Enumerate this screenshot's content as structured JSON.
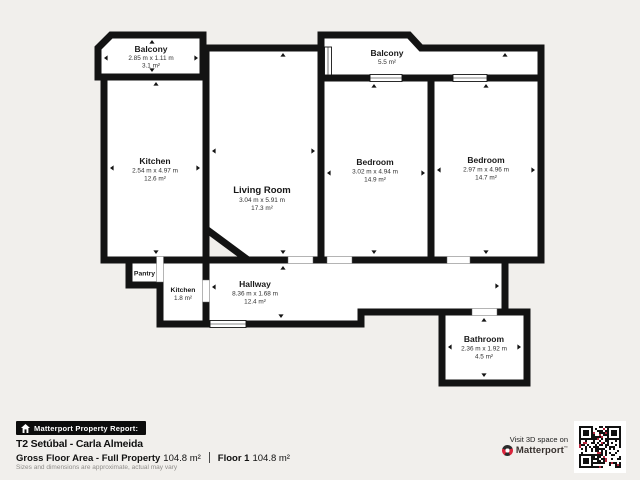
{
  "plan": {
    "rooms": {
      "balcony_tl": {
        "name": "Balcony",
        "dims": "2.85 m x 1.11 m",
        "area": "3.1 m²"
      },
      "kitchen": {
        "name": "Kitchen",
        "dims": "2.54 m x 4.97 m",
        "area": "12.6 m²"
      },
      "living": {
        "name": "Living Room",
        "dims": "3.04 m x 5.91 m",
        "area": "17.3 m²"
      },
      "balcony_tr": {
        "name": "Balcony",
        "area": "5.5 m²"
      },
      "bedroom_l": {
        "name": "Bedroom",
        "dims": "3.02 m x 4.94 m",
        "area": "14.9 m²"
      },
      "bedroom_r": {
        "name": "Bedroom",
        "dims": "2.97 m x 4.96 m",
        "area": "14.7 m²"
      },
      "pantry": {
        "name": "Pantry"
      },
      "kitchen_small": {
        "name": "Kitchen",
        "area": "1.8 m²"
      },
      "hallway": {
        "name": "Hallway",
        "dims": "8.36 m x 1.68 m",
        "area": "12.4 m²"
      },
      "bathroom": {
        "name": "Bathroom",
        "dims": "2.36 m x 1.92 m",
        "area": "4.5 m²"
      }
    }
  },
  "footer": {
    "badge_label": "Matterport Property Report:",
    "property_title": "T2 Setúbal - Carla Almeida",
    "gross_area_label": "Gross Floor Area - Full Property",
    "gross_area_value": "104.8 m²",
    "floor_label": "Floor 1",
    "floor_value": "104.8 m²",
    "disclaimer": "Sizes and dimensions are approximate, actual may vary",
    "visit_text": "Visit 3D space on",
    "brand_name": "Matterport",
    "brand_mark": "™"
  },
  "colors": {
    "wall": "#131313",
    "background": "#f1efec",
    "brand_red": "#d9243b"
  }
}
